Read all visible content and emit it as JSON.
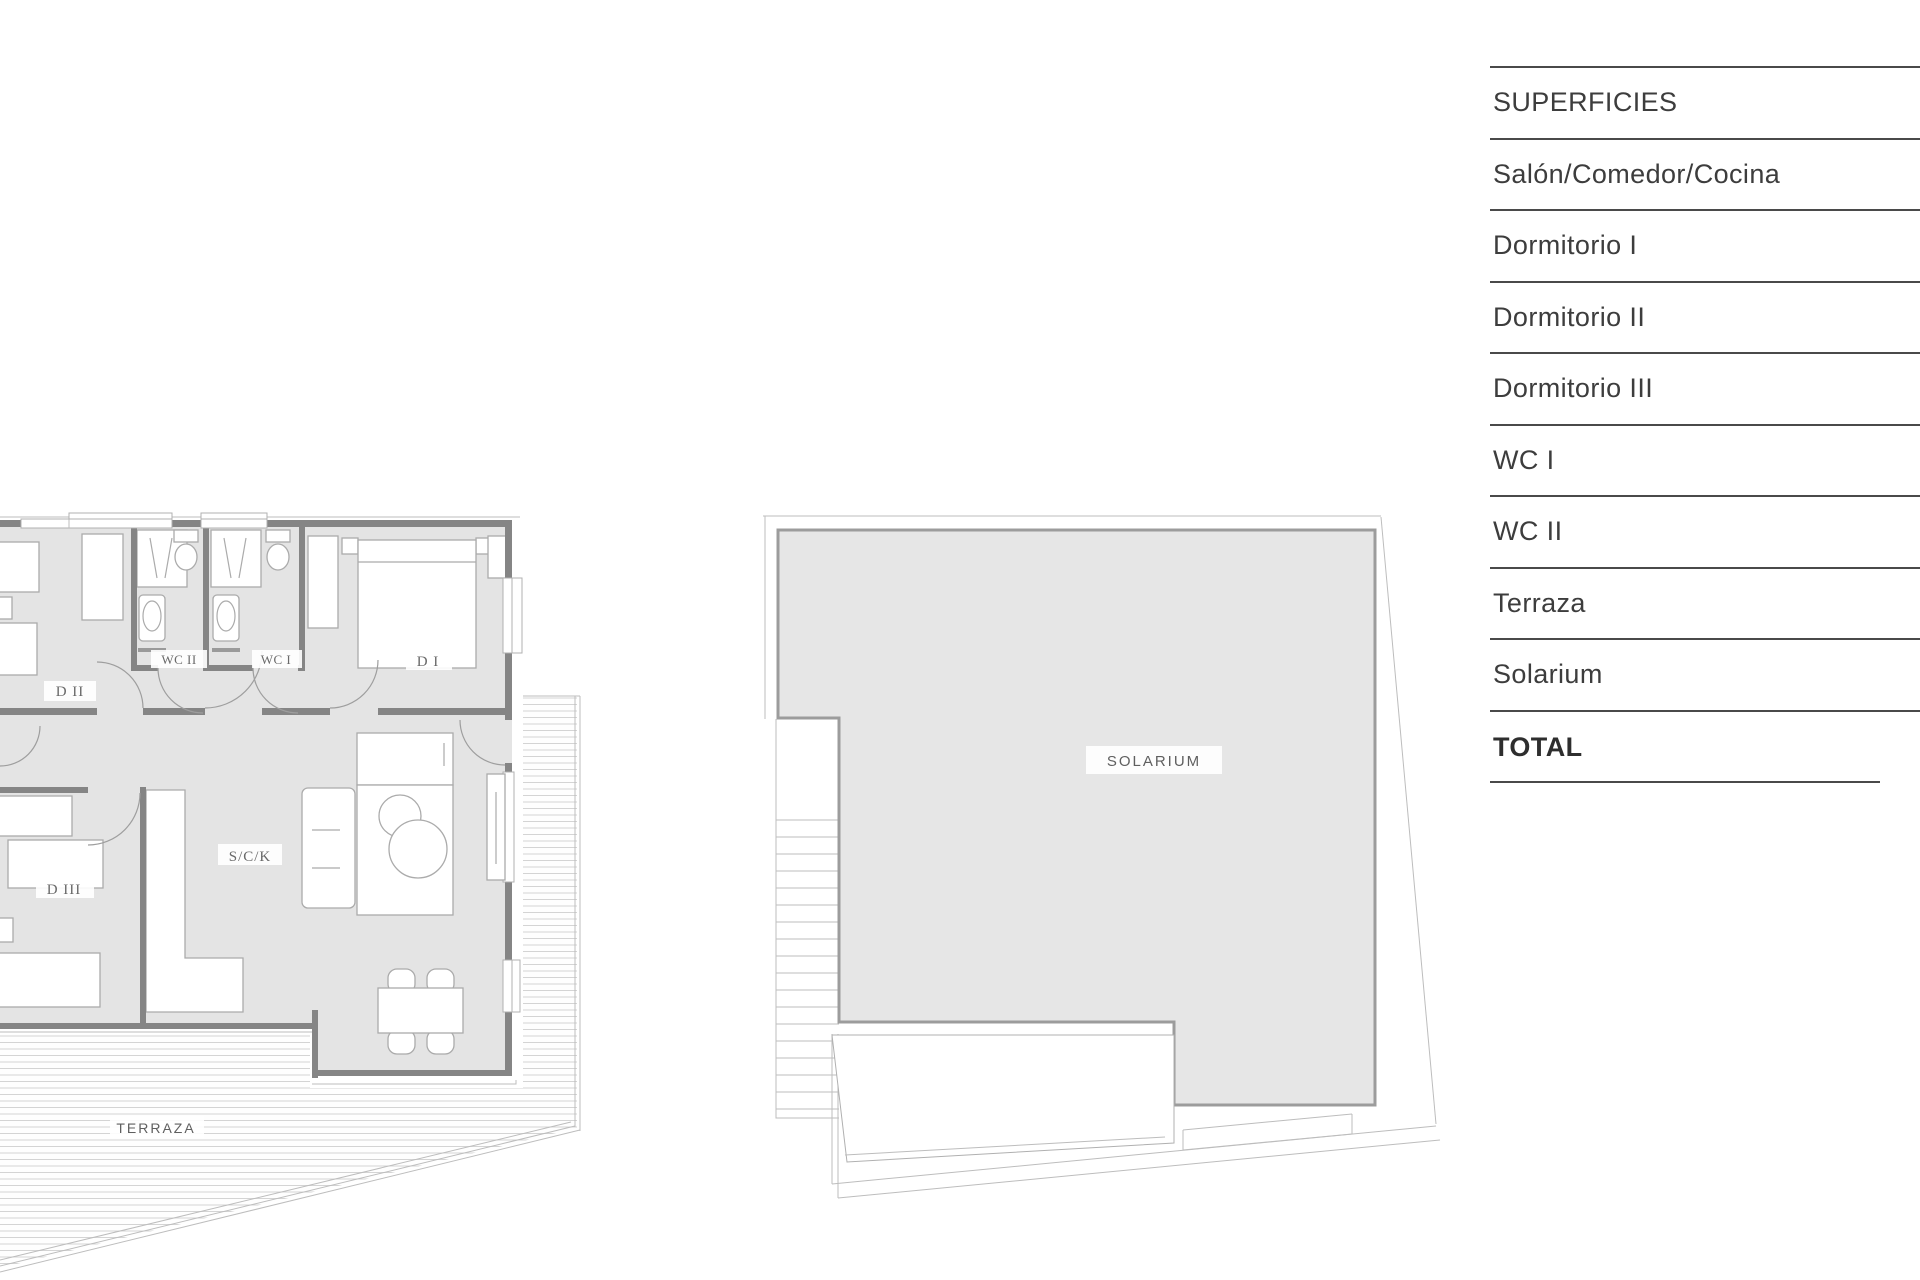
{
  "surfaces_table": {
    "header": "SUPERFICIES",
    "rows": [
      "Salón/Comedor/Cocina",
      "Dormitorio I",
      "Dormitorio II",
      "Dormitorio III",
      "WC I",
      "WC II",
      "Terraza",
      "Solarium"
    ],
    "total_label": "TOTAL"
  },
  "floor_plan": {
    "rooms": {
      "d2": "D II",
      "wc2": "WC II",
      "wc1": "WC I",
      "d1": "D I",
      "sck": "S/C/K",
      "d3": "D III",
      "terraza": "TERRAZA"
    }
  },
  "roof_plan": {
    "rooms": {
      "solarium": "SOLARIUM"
    }
  },
  "colors": {
    "floor_fill": "#e4e4e4",
    "roof_fill": "#e6e6e6",
    "wall": "#858585",
    "table_line": "#4a4a4a",
    "table_text": "#3d3d3d",
    "label_text": "#696969"
  }
}
